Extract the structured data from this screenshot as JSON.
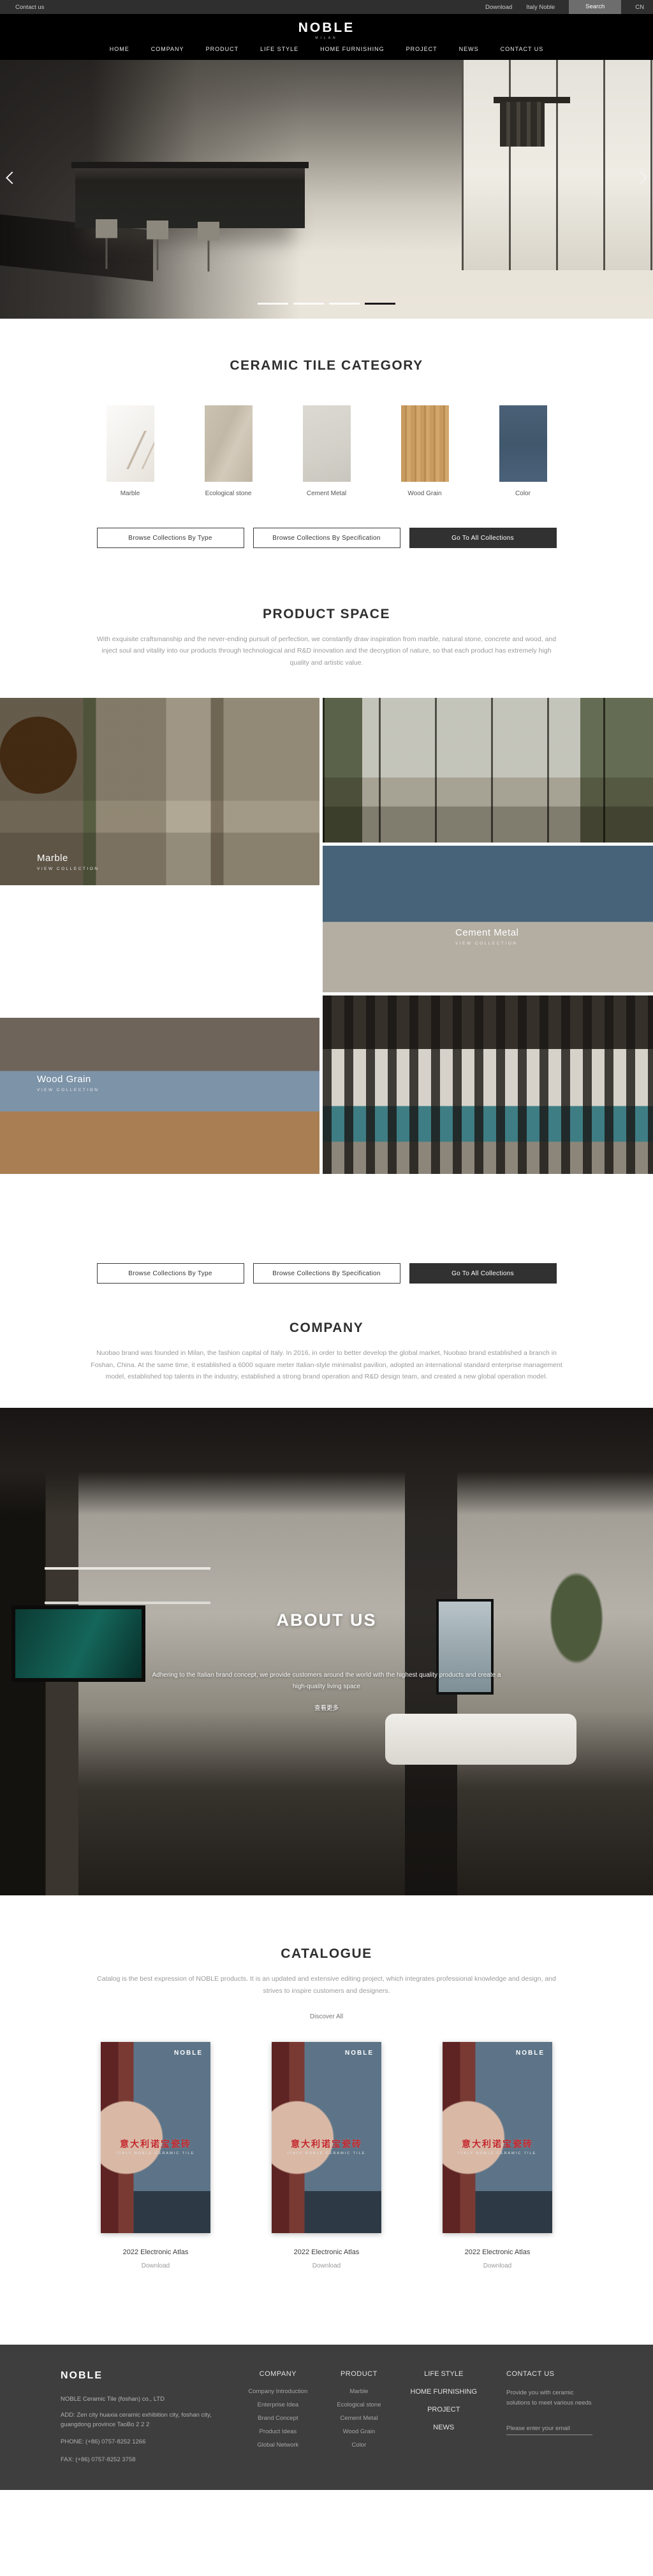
{
  "topbar": {
    "contact_us": "Contact us",
    "download": "Download",
    "italy_noble": "Italy Noble",
    "search": "Search",
    "lang": "CN"
  },
  "header": {
    "logo": "NOBLE",
    "logo_subtitle": "MILAN",
    "nav": [
      "HOME",
      "COMPANY",
      "PRODUCT",
      "LIFE STYLE",
      "HOME FURNISHING",
      "PROJECT",
      "NEWS",
      "CONTACT US"
    ]
  },
  "hero": {
    "slide_count": "4",
    "active_slide": "4"
  },
  "category": {
    "title": "CERAMIC TILE CATEGORY",
    "tiles": [
      {
        "label": "Marble"
      },
      {
        "label": "Ecological stone"
      },
      {
        "label": "Cement Metal"
      },
      {
        "label": "Wood Grain"
      },
      {
        "label": "Color"
      }
    ]
  },
  "buttons": {
    "by_type": "Browse Collections By Type",
    "by_spec": "Browse Collections By Specification",
    "all": "Go To All Collections"
  },
  "product_space": {
    "title": "PRODUCT SPACE",
    "description": "With exquisite craftsmanship and the never-ending pursuit of perfection, we constantly draw inspiration from marble, natural stone, concrete and wood, and inject soul and vitality into our products through technological and R&D innovation and the decryption of nature, so that each product has extremely high quality and artistic value.",
    "overlays": [
      {
        "label": "Marble",
        "cta": "VIEW COLLECTION"
      },
      {
        "label": "Cement Metal",
        "cta": "VIEW COLLECTION"
      },
      {
        "label": "Wood Grain",
        "cta": "VIEW COLLECTION"
      }
    ]
  },
  "company": {
    "title": "COMPANY",
    "description": "Nuobao brand was founded in Milan, the fashion capital of Italy. In 2016, in order to better develop the global market, Nuobao brand established a branch in Foshan, China. At the same time, it established a 6000 square meter Italian-style minimalist pavilion, adopted an international standard enterprise management model, established top talents in the industry, established a strong brand operation and R&D design team, and created a new global operation model."
  },
  "about": {
    "title": "ABOUT US",
    "description": "Adhering to the Italian brand concept, we provide customers around the world with the highest quality products and create a high-quality living space",
    "more": "查看更多"
  },
  "catalogue": {
    "title": "CATALOGUE",
    "description": "Catalog is the best expression of NOBLE products. It is an updated and extensive editing project, which integrates professional knowledge and design, and strives to inspire customers and designers.",
    "discover": "Discover All",
    "items": [
      {
        "cover_brand": "NOBLE",
        "cover_title": "意大利诺宝瓷砖",
        "cover_sub": "ITALY NOBLE CERAMIC TILE",
        "title": "2022 Electronic Atlas",
        "action": "Download"
      },
      {
        "cover_brand": "NOBLE",
        "cover_title": "意大利诺宝瓷砖",
        "cover_sub": "ITALY NOBLE CERAMIC TILE",
        "title": "2022 Electronic Atlas",
        "action": "Download"
      },
      {
        "cover_brand": "NOBLE",
        "cover_title": "意大利诺宝瓷砖",
        "cover_sub": "ITALY NOBLE CERAMIC TILE",
        "title": "2022 Electronic Atlas",
        "action": "Download"
      }
    ]
  },
  "footer": {
    "logo": "NOBLE",
    "company_name": "NOBLE Ceramic Tile (foshan) co., LTD",
    "address": "ADD:  Zen city huaxia ceramic exhibition city, foshan city, guangdong province TaoBo 2 2 2",
    "phone": "PHONE:   (+86) 0757-8252 1266",
    "fax": "FAX:   (+86) 0757-8252 3758",
    "company_col": {
      "title": "COMPANY",
      "items": [
        "Company Introduction",
        "Enterprise Idea",
        "Brand Concept",
        "Product Ideas",
        "Global Network"
      ]
    },
    "product_col": {
      "title": "PRODUCT",
      "items": [
        "Marble",
        "Ecological stone",
        "Cement Metal",
        "Wood Grain",
        "Color"
      ]
    },
    "nav_col": {
      "items": [
        "LIFE STYLE",
        "HOME FURNISHING",
        "PROJECT",
        "NEWS"
      ]
    },
    "contact_col": {
      "title": "CONTACT US",
      "blurb": "Provide you with ceramic solutions to meet various needs",
      "email_placeholder": "Please enter your email"
    }
  }
}
